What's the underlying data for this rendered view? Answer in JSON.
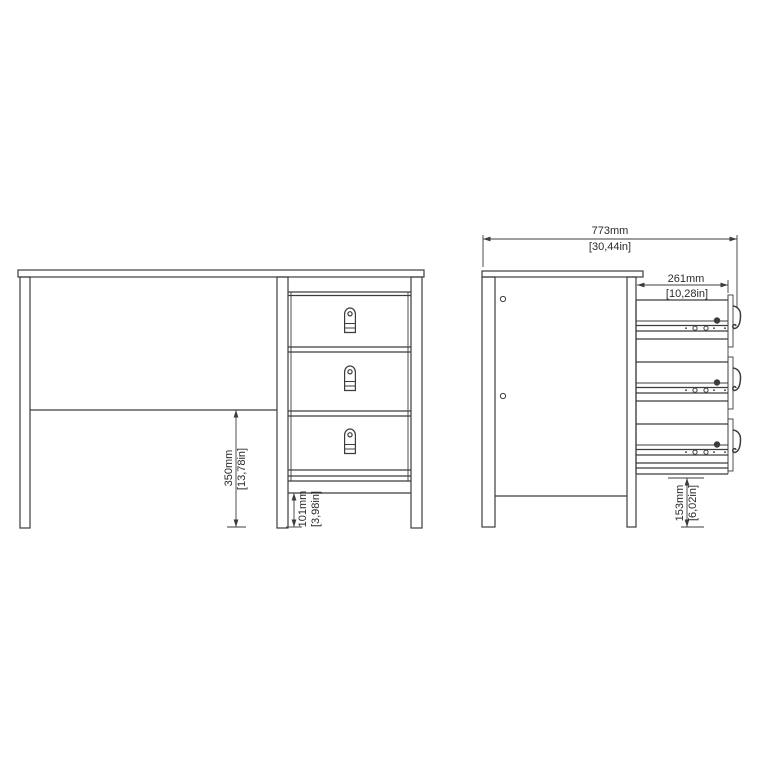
{
  "canvas": {
    "background": "#ffffff",
    "line_color": "#3c3c3c",
    "text_color": "#2b2b2b"
  },
  "drawing": {
    "type": "furniture-technical-drawing",
    "subject": "desk with 3 drawers, front view and side view",
    "views": [
      "front-view",
      "side-view"
    ],
    "drawer_count": 3
  },
  "icons": {
    "drawer-handle-icon": "rounded pull tab with button circle",
    "drawer-pull-side-icon": "J-shaped hook profile",
    "screw-icon": "filled circle",
    "rail-hole-icon": "small open circle",
    "panel-hole-icon": "small open circle"
  },
  "dimensions": {
    "overall_depth": {
      "mm": "773mm",
      "inches": "[30,44in]"
    },
    "drawer_depth": {
      "mm": "261mm",
      "inches": "[10,28in]"
    },
    "under_desk_clearance": {
      "mm": "350mm",
      "inches": "[13,78in]"
    },
    "base_rail_clearance": {
      "mm": "101mm",
      "inches": "[3,98in]"
    },
    "side_base_clearance": {
      "mm": "153mm",
      "inches": "[6,02in]"
    }
  }
}
